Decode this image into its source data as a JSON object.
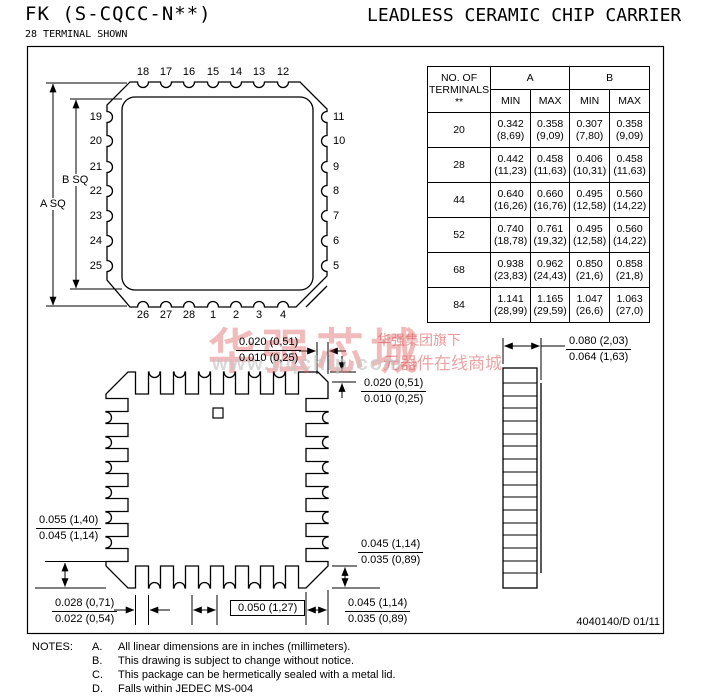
{
  "header": {
    "title_left": "FK (S-CQCC-N**)",
    "subtitle": "28 TERMINAL SHOWN",
    "title_right": "LEADLESS CERAMIC CHIP CARRIER"
  },
  "top_view": {
    "label_a": "A SQ",
    "label_b": "B SQ",
    "pins_top": [
      "18",
      "17",
      "16",
      "15",
      "14",
      "13",
      "12"
    ],
    "pins_left": [
      "19",
      "20",
      "21",
      "22",
      "23",
      "24",
      "25"
    ],
    "pins_right": [
      "11",
      "10",
      "9",
      "8",
      "7",
      "6",
      "5"
    ],
    "pins_bottom": [
      "26",
      "27",
      "28",
      "1",
      "2",
      "3",
      "4"
    ]
  },
  "table": {
    "col1_header": "NO. OF\nTERMINALS\n**",
    "group_a": "A",
    "group_b": "B",
    "min": "MIN",
    "max": "MAX",
    "rows": [
      {
        "n": "20",
        "a_min": "0.342\n(8,69)",
        "a_max": "0.358\n(9,09)",
        "b_min": "0.307\n(7,80)",
        "b_max": "0.358\n(9,09)"
      },
      {
        "n": "28",
        "a_min": "0.442\n(11,23)",
        "a_max": "0.458\n(11,63)",
        "b_min": "0.406\n(10,31)",
        "b_max": "0.458\n(11,63)"
      },
      {
        "n": "44",
        "a_min": "0.640\n(16,26)",
        "a_max": "0.660\n(16,76)",
        "b_min": "0.495\n(12,58)",
        "b_max": "0.560\n(14,22)"
      },
      {
        "n": "52",
        "a_min": "0.740\n(18,78)",
        "a_max": "0.761\n(19,32)",
        "b_min": "0.495\n(12,58)",
        "b_max": "0.560\n(14,22)"
      },
      {
        "n": "68",
        "a_min": "0.938\n(23,83)",
        "a_max": "0.962\n(24,43)",
        "b_min": "0.850\n(21,6)",
        "b_max": "0.858\n(21,8)"
      },
      {
        "n": "84",
        "a_min": "1.141\n(28,99)",
        "a_max": "1.165\n(29,59)",
        "b_min": "1.047\n(26,6)",
        "b_max": "1.063\n(27,0)"
      }
    ]
  },
  "dimensions": {
    "chamfer_top_h": {
      "top": "0.020 (0,51)",
      "bottom": "0.010 (0,25)"
    },
    "chamfer_top_v": {
      "top": "0.020 (0,51)",
      "bottom": "0.010 (0,25)"
    },
    "lid_width": {
      "top": "0.080 (2,03)",
      "bottom": "0.064 (1,63)"
    },
    "corner_left": {
      "top": "0.055 (1,40)",
      "bottom": "0.045 (1,14)"
    },
    "terminal_width": {
      "top": "0.028 (0,71)",
      "bottom": "0.022 (0,54)"
    },
    "pitch": "0.050 (1,27)",
    "corner_right_v": {
      "top": "0.045 (1,14)",
      "bottom": "0.035 (0,89)"
    },
    "corner_right_h": {
      "top": "0.045 (1,14)",
      "bottom": "0.035 (0,89)"
    }
  },
  "notes": {
    "label": "NOTES:",
    "items": [
      {
        "letter": "A.",
        "text": "All linear dimensions are in inches (millimeters)."
      },
      {
        "letter": "B.",
        "text": "This drawing is subject to change without notice."
      },
      {
        "letter": "C.",
        "text": "This package can be hermetically sealed with a metal lid."
      },
      {
        "letter": "D.",
        "text": "Falls within JEDEC MS-004"
      }
    ]
  },
  "footer": {
    "doc_number": "4040140/D 01/11"
  },
  "watermark": {
    "main": "华强芯城",
    "line1": "华强集团旗下",
    "line2": "元器件在线商城",
    "url": "www.hqchip.com",
    "color": "#d9534f"
  }
}
